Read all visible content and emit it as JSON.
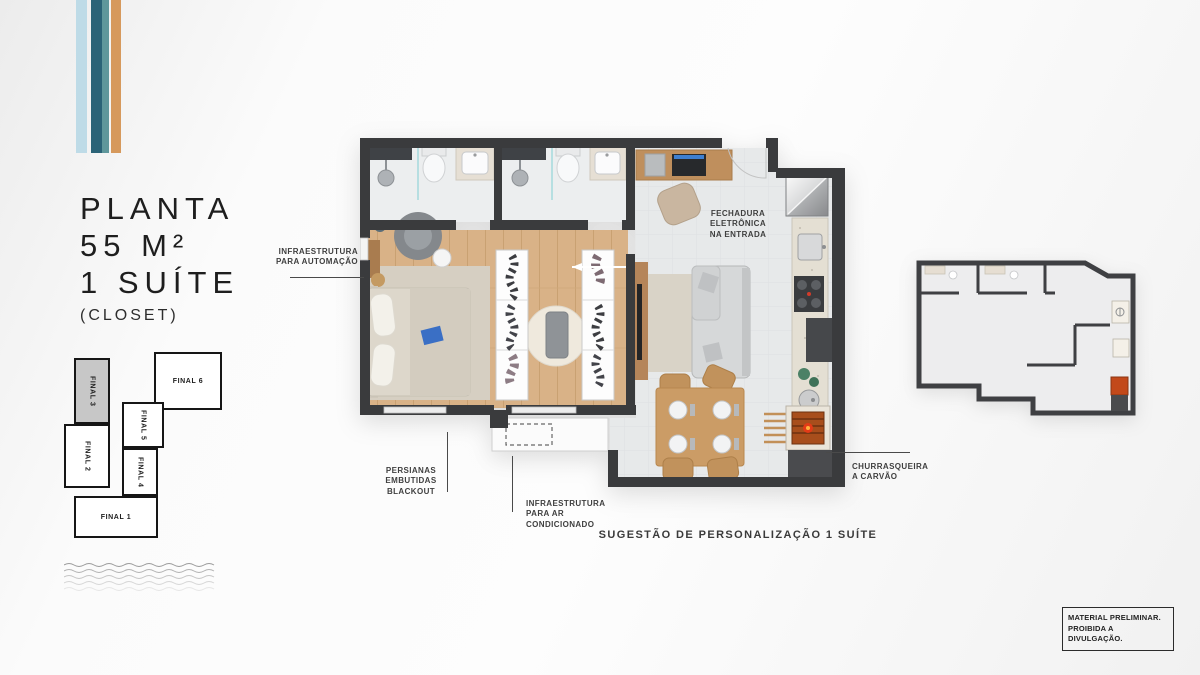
{
  "brand": {
    "stripe_colors": [
      "#bedbe7",
      "#2b6377",
      "#5f979b",
      "#d6995c"
    ]
  },
  "title": {
    "line1": "PLANTA",
    "line2": "55 M²",
    "line3": "1 SUÍTE",
    "line4": "(CLOSET)"
  },
  "key_plan": {
    "units": [
      {
        "label": "FINAL 3",
        "highlighted": true
      },
      {
        "label": "FINAL 6",
        "highlighted": false
      },
      {
        "label": "FINAL 2",
        "highlighted": false
      },
      {
        "label": "FINAL 5",
        "highlighted": false
      },
      {
        "label": "FINAL 4",
        "highlighted": false
      },
      {
        "label": "FINAL 1",
        "highlighted": false
      }
    ]
  },
  "floor_plan": {
    "annotations": {
      "automation": "INFRAESTRUTURA\nPARA AUTOMAÇÃO",
      "electronic_lock": "FECHADURA\nELETRÔNICA\nNA ENTRADA",
      "blinds": "PERSIANAS\nEMBUTIDAS\nBLACKOUT",
      "air_conditioning": "INFRAESTRUTURA\nPARA AR\nCONDICIONADO",
      "charcoal_grill": "CHURRASQUEIRA\nA CARVÃO"
    },
    "caption": "SUGESTÃO DE PERSONALIZAÇÃO 1 SUÍTE"
  },
  "disclaimer": "MATERIAL PRELIMINAR.\nPROIBIDA A DIVULGAÇÃO.",
  "colors": {
    "wall": "#3a3b3d",
    "wood_floor": "#d9b287",
    "tile_floor": "#e7e9ea",
    "counter": "#e4dfd3",
    "grill_ember": "#c2491a",
    "highlight_unit": "#c7c7c7"
  }
}
